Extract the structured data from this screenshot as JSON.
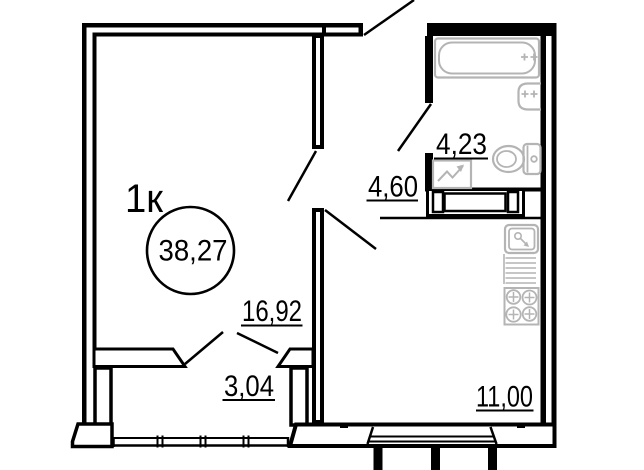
{
  "plan": {
    "unit_label": "1к",
    "total_area": "38,27",
    "rooms": [
      {
        "name": "living-room",
        "area": "16,92"
      },
      {
        "name": "hallway",
        "area": "4,60"
      },
      {
        "name": "bathroom",
        "area": "4,23"
      },
      {
        "name": "kitchen",
        "area": "11,00"
      },
      {
        "name": "balcony",
        "area": "3,04"
      }
    ],
    "fixtures": [
      "bathtub",
      "washbasin",
      "toilet",
      "washing-machine",
      "vent-shaft",
      "kitchen-sink",
      "drying-rack",
      "stove"
    ],
    "colors": {
      "walls": "#000000",
      "fixtures": "#b4b4b4",
      "background": "#ffffff"
    }
  }
}
